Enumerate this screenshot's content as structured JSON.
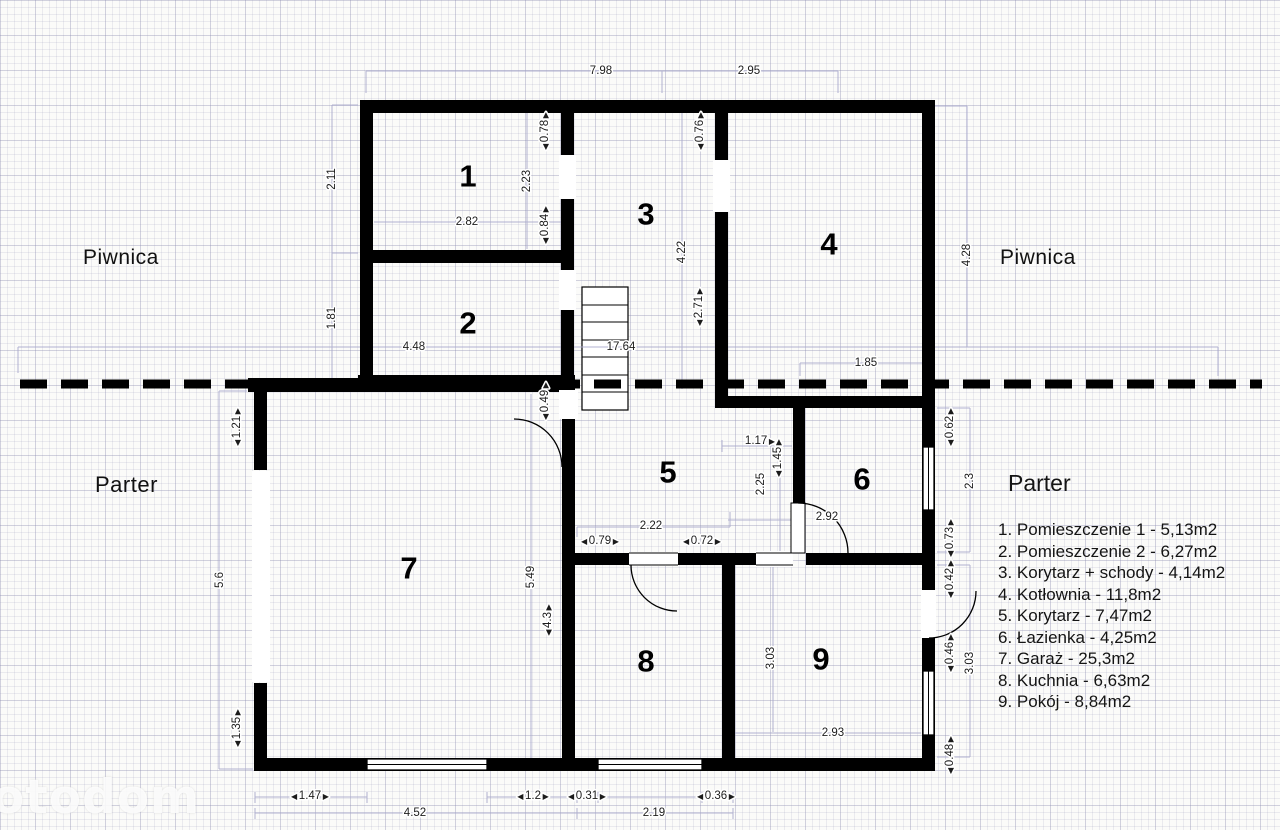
{
  "plan": {
    "section_labels": {
      "basement_left": "Piwnica",
      "basement_right": "Piwnica",
      "ground_left": "Parter"
    },
    "room_numbers": [
      {
        "label": "1",
        "x": 468,
        "y": 176
      },
      {
        "label": "2",
        "x": 468,
        "y": 323
      },
      {
        "label": "3",
        "x": 646,
        "y": 214
      },
      {
        "label": "4",
        "x": 829,
        "y": 244
      },
      {
        "label": "5",
        "x": 668,
        "y": 472
      },
      {
        "label": "6",
        "x": 862,
        "y": 479
      },
      {
        "label": "7",
        "x": 409,
        "y": 568
      },
      {
        "label": "8",
        "x": 646,
        "y": 661
      },
      {
        "label": "9",
        "x": 821,
        "y": 659
      }
    ],
    "dimensions": [
      {
        "value": "7.98",
        "x": 601,
        "y": 71
      },
      {
        "value": "2.95",
        "x": 749,
        "y": 71
      },
      {
        "value": "2.11",
        "x": 332,
        "y": 179,
        "rot": true
      },
      {
        "value": "1.81",
        "x": 332,
        "y": 318,
        "rot": true
      },
      {
        "value": "2.82",
        "x": 467,
        "y": 222
      },
      {
        "value": "2.23",
        "x": 527,
        "y": 181,
        "rot": true
      },
      {
        "value": "0.78",
        "x": 545,
        "y": 131,
        "rot": true,
        "arrows": "both"
      },
      {
        "value": "0.84",
        "x": 545,
        "y": 225,
        "rot": true,
        "arrows": "both"
      },
      {
        "value": "0.76",
        "x": 700,
        "y": 131,
        "rot": true,
        "arrows": "both"
      },
      {
        "value": "4.22",
        "x": 682,
        "y": 252,
        "rot": true
      },
      {
        "value": "2.71",
        "x": 699,
        "y": 307,
        "rot": true,
        "arrows": "both"
      },
      {
        "value": "4.28",
        "x": 967,
        "y": 255,
        "rot": true
      },
      {
        "value": "4.48",
        "x": 414,
        "y": 347
      },
      {
        "value": "17.64",
        "x": 621,
        "y": 347
      },
      {
        "value": "1.85",
        "x": 866,
        "y": 363
      },
      {
        "value": "0.49",
        "x": 545,
        "y": 401,
        "rot": true,
        "arrows": "both"
      },
      {
        "value": "1.21",
        "x": 237,
        "y": 427,
        "rot": true,
        "arrows": "both"
      },
      {
        "value": "1.17",
        "x": 760,
        "y": 441,
        "arrows": "end"
      },
      {
        "value": "1.45",
        "x": 778,
        "y": 458,
        "rot": true,
        "arrows": "both"
      },
      {
        "value": "2.25",
        "x": 761,
        "y": 484,
        "rot": true
      },
      {
        "value": "2.92",
        "x": 827,
        "y": 517
      },
      {
        "value": "0.62",
        "x": 950,
        "y": 427,
        "rot": true,
        "arrows": "both"
      },
      {
        "value": "2.3",
        "x": 970,
        "y": 481,
        "rot": true
      },
      {
        "value": "0.73",
        "x": 950,
        "y": 538,
        "rot": true,
        "arrows": "both"
      },
      {
        "value": "0.42",
        "x": 950,
        "y": 579,
        "rot": true,
        "arrows": "both"
      },
      {
        "value": "0.46",
        "x": 950,
        "y": 653,
        "rot": true,
        "arrows": "both"
      },
      {
        "value": "3.03",
        "x": 970,
        "y": 663,
        "rot": true
      },
      {
        "value": "0.48",
        "x": 950,
        "y": 755,
        "rot": true,
        "arrows": "both"
      },
      {
        "value": "3.03",
        "x": 771,
        "y": 658,
        "rot": true
      },
      {
        "value": "2.93",
        "x": 833,
        "y": 733
      },
      {
        "value": "5.6",
        "x": 220,
        "y": 580,
        "rot": true
      },
      {
        "value": "5.49",
        "x": 531,
        "y": 577,
        "rot": true
      },
      {
        "value": "4.3",
        "x": 548,
        "y": 620,
        "rot": true,
        "arrows": "both"
      },
      {
        "value": "2.22",
        "x": 651,
        "y": 526
      },
      {
        "value": "0.79",
        "x": 600,
        "y": 541,
        "arrows": "both"
      },
      {
        "value": "0.72",
        "x": 702,
        "y": 541,
        "arrows": "both"
      },
      {
        "value": "1.35",
        "x": 237,
        "y": 728,
        "rot": true,
        "arrows": "both"
      },
      {
        "value": "1.47",
        "x": 310,
        "y": 796,
        "arrows": "both"
      },
      {
        "value": "1.2",
        "x": 533,
        "y": 796,
        "arrows": "both"
      },
      {
        "value": "0.31",
        "x": 587,
        "y": 796,
        "arrows": "both"
      },
      {
        "value": "0.36",
        "x": 716,
        "y": 796,
        "arrows": "both"
      },
      {
        "value": "4.52",
        "x": 415,
        "y": 813
      },
      {
        "value": "2.19",
        "x": 654,
        "y": 813
      }
    ]
  },
  "legend": {
    "title": "Parter",
    "items": [
      "1. Pomieszczenie 1 - 5,13m2",
      "2. Pomieszczenie 2 - 6,27m2",
      "3. Korytarz + schody - 4,14m2",
      "4. Kotłownia - 11,8m2",
      "5. Korytarz - 7,47m2",
      "6. Łazienka - 4,25m2",
      "7. Garaż - 25,3m2",
      "8. Kuchnia - 6,63m2",
      "9. Pokój - 8,84m2"
    ]
  },
  "watermark": {
    "text": "otodom"
  },
  "colors": {
    "wall": "#000000",
    "dim_line": "#a9a9cc",
    "dim_text": "#1c1c1c",
    "watermark": "#ffffff"
  }
}
